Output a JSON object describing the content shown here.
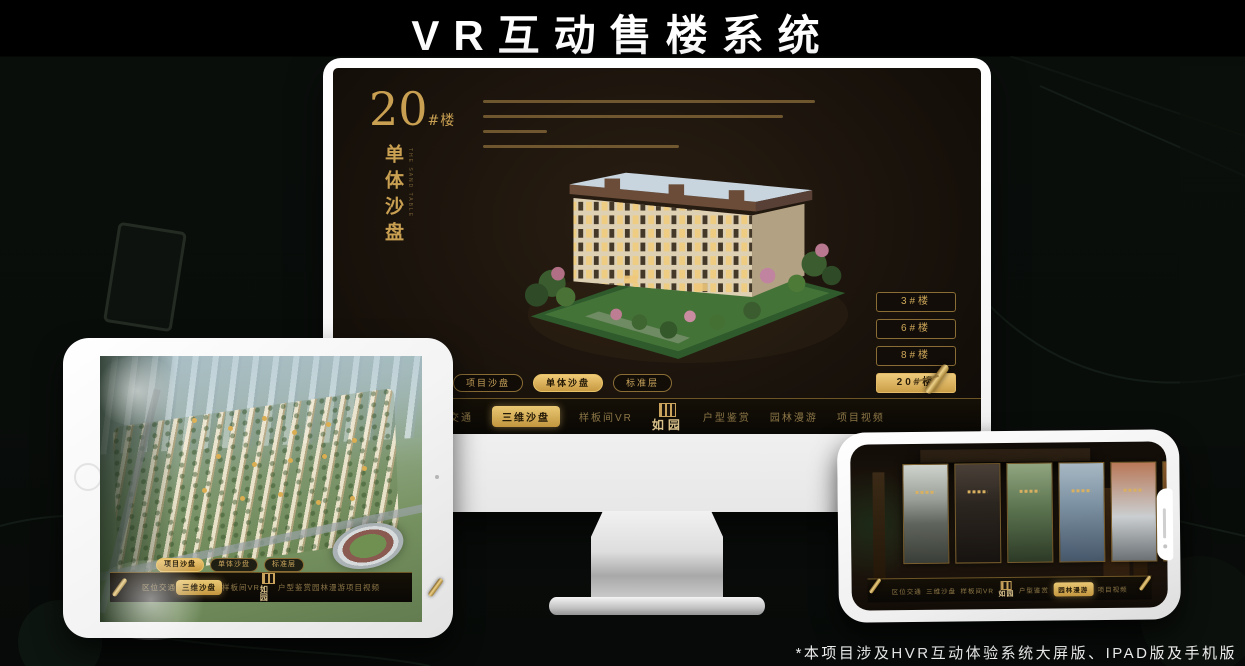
{
  "page": {
    "title": "VR互动售楼系统",
    "footnote": "*本项目涉及HVR互动体验系统大屏版、IPAD版及手机版"
  },
  "colors": {
    "gold": "#c9a052",
    "gold_bright": "#e8c674",
    "screen_bg": "#15100a",
    "nav_bg": "#0b0906",
    "device_body": "#f4f4f4"
  },
  "logo": {
    "text": "如园"
  },
  "monitor": {
    "heading_number": "20",
    "heading_suffix": "#楼",
    "heading_vertical": "单体沙盘",
    "heading_vertical_en": "THE SAND TABLE",
    "floor_buttons": [
      {
        "label": "3#楼",
        "selected": false
      },
      {
        "label": "6#楼",
        "selected": false
      },
      {
        "label": "8#楼",
        "selected": false
      },
      {
        "label": "20#楼",
        "selected": true
      }
    ],
    "sub_tabs": [
      {
        "label": "项目沙盘",
        "selected": false
      },
      {
        "label": "单体沙盘",
        "selected": true
      },
      {
        "label": "标准层",
        "selected": false
      }
    ],
    "nav_left": [
      {
        "label": "区位交通",
        "selected": false
      },
      {
        "label": "三维沙盘",
        "selected": true
      },
      {
        "label": "样板间VR",
        "selected": false
      }
    ],
    "nav_right": [
      {
        "label": "户型鉴赏",
        "selected": false
      },
      {
        "label": "园林漫游",
        "selected": false
      },
      {
        "label": "项目视频",
        "selected": false
      }
    ]
  },
  "tablet": {
    "sub_tabs": [
      {
        "label": "项目沙盘",
        "selected": true
      },
      {
        "label": "单体沙盘",
        "selected": false
      },
      {
        "label": "标准层",
        "selected": false
      }
    ],
    "nav_left": [
      {
        "label": "区位交通",
        "selected": false
      },
      {
        "label": "三维沙盘",
        "selected": true
      },
      {
        "label": "样板间VR",
        "selected": false
      }
    ],
    "nav_right": [
      {
        "label": "户型鉴赏",
        "selected": false
      },
      {
        "label": "园林漫游",
        "selected": false
      },
      {
        "label": "项目视频",
        "selected": false
      }
    ]
  },
  "phone": {
    "nav_left": [
      {
        "label": "区位交通",
        "selected": false
      },
      {
        "label": "三维沙盘",
        "selected": false
      },
      {
        "label": "样板间VR",
        "selected": false
      }
    ],
    "nav_right": [
      {
        "label": "户型鉴赏",
        "selected": false
      },
      {
        "label": "园林漫游",
        "selected": true
      },
      {
        "label": "项目视频",
        "selected": false
      }
    ],
    "panels": [
      {
        "name": "courtyard-gray"
      },
      {
        "name": "interior-dark"
      },
      {
        "name": "garden-green"
      },
      {
        "name": "tower-blue"
      },
      {
        "name": "autumn-court"
      },
      {
        "name": "cabinet-warm"
      }
    ]
  }
}
